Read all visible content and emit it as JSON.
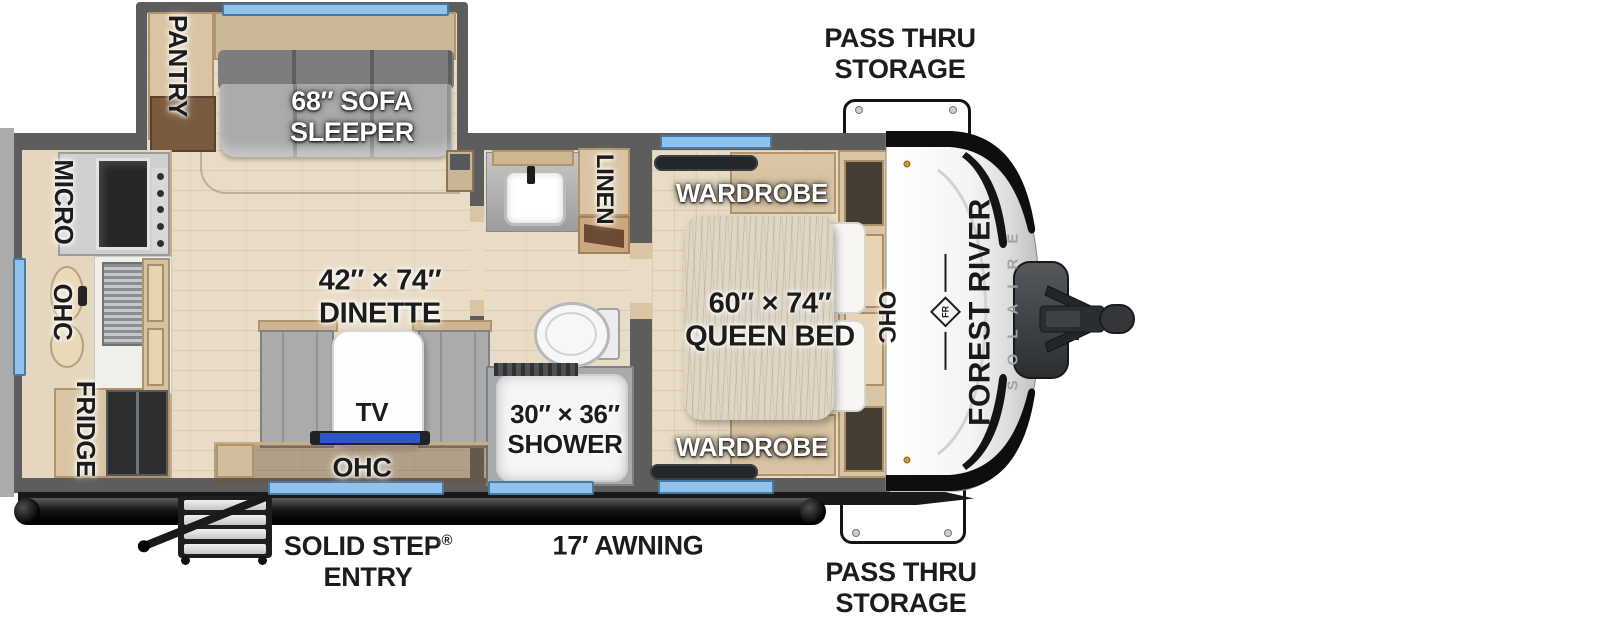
{
  "floorplan": {
    "brand": {
      "manufacturer": "FOREST RIVER",
      "model": "SOLAIRE",
      "logo_monogram": "FR"
    },
    "exterior": {
      "pass_thru_storage_top": [
        "PASS THRU",
        "STORAGE"
      ],
      "pass_thru_storage_bottom": [
        "PASS THRU",
        "STORAGE"
      ],
      "awning": "17′ AWNING",
      "entry": {
        "line1": "SOLID STEP",
        "registered": "®",
        "line2": "ENTRY"
      }
    },
    "living": {
      "pantry": "PANTRY",
      "sofa": [
        "68″ SOFA",
        "SLEEPER"
      ],
      "dinette": [
        "42″ × 74″",
        "DINETTE"
      ],
      "tv": "TV",
      "dinette_ohc": "OHC"
    },
    "kitchen": {
      "micro": "MICRO",
      "ohc": "OHC",
      "fridge": "FRIDGE"
    },
    "bathroom": {
      "linen": "LINEN",
      "shower": [
        "30″ × 36″",
        "SHOWER"
      ]
    },
    "bedroom": {
      "wardrobe_top": "WARDROBE",
      "wardrobe_bottom": "WARDROBE",
      "bed": [
        "60″ × 74″",
        "QUEEN BED"
      ],
      "ohc": "OHC"
    }
  },
  "colors": {
    "wall": "#5d5d5d",
    "floor": "#e8dcc6",
    "window": "#8fc2ec",
    "wood": "#d9c5a4",
    "cushion": "#ababab",
    "tv_screen": "#2f55cc",
    "cap_black": "#0e0e0e",
    "label_dark": "#1c1c1c",
    "label_light": "#ffffff"
  }
}
